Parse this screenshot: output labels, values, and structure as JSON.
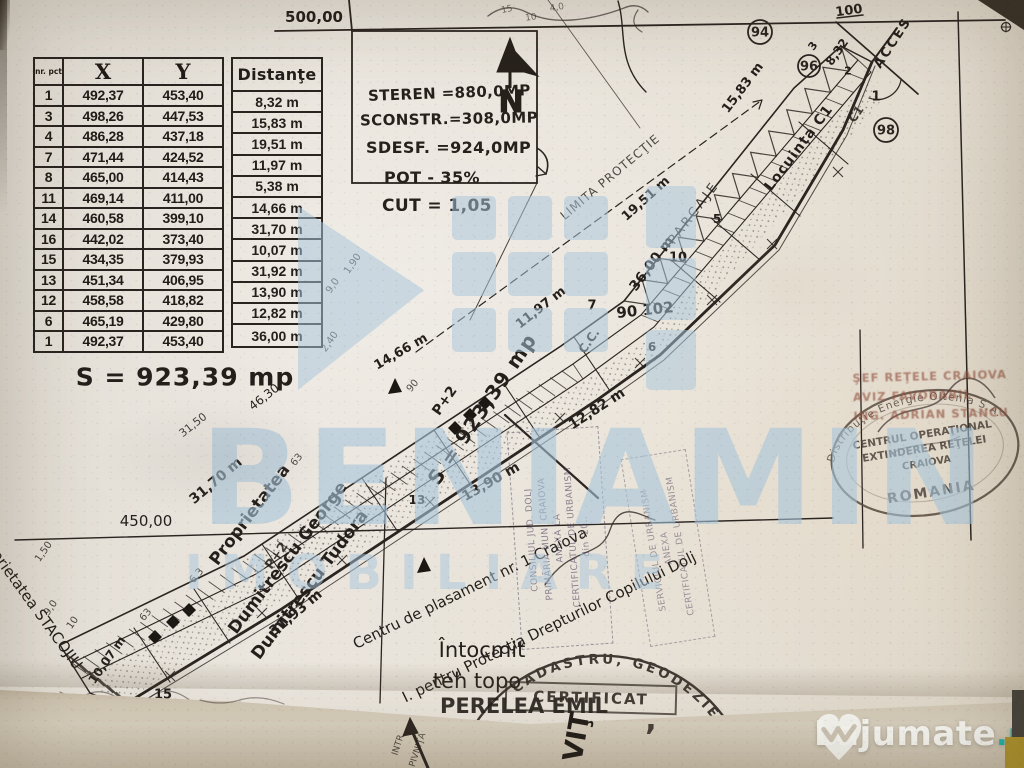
{
  "colors": {
    "paper": "#e8e3dc",
    "ink": "#2b2521",
    "watermark_blue": "#a7c5db",
    "lajumate_teal": "#1db6ae",
    "stamp_red": "#92503e",
    "fold": "#cfc5b2"
  },
  "survey_table": {
    "col_headers": [
      "nr. pct",
      "X",
      "Y"
    ],
    "dist_header": "Distanţe",
    "rows": [
      [
        "1",
        "492,37",
        "453,40"
      ],
      [
        "3",
        "498,26",
        "447,53"
      ],
      [
        "4",
        "486,28",
        "437,18"
      ],
      [
        "7",
        "471,44",
        "424,52"
      ],
      [
        "8",
        "465,00",
        "414,43"
      ],
      [
        "11",
        "469,14",
        "411,00"
      ],
      [
        "14",
        "460,58",
        "399,10"
      ],
      [
        "16",
        "442,02",
        "373,40"
      ],
      [
        "15",
        "434,35",
        "379,93"
      ],
      [
        "13",
        "451,34",
        "406,95"
      ],
      [
        "12",
        "458,58",
        "418,82"
      ],
      [
        "6",
        "465,19",
        "429,80"
      ],
      [
        "1",
        "492,37",
        "453,40"
      ]
    ],
    "distances": [
      "8,32 m",
      "15,83 m",
      "19,51 m",
      "11,97 m",
      "5,38 m",
      "14,66 m",
      "31,70 m",
      "10,07 m",
      "31,92 m",
      "13,90 m",
      "12,82 m",
      "36,00 m"
    ],
    "area": "S = 923,39 mp"
  },
  "parameters": {
    "lines": [
      "STEREN =880,0MP",
      "SCONSTR.=308,0MP",
      "SDESF. =924,0MP",
      "POT - 35%",
      "CUT = 1,05"
    ]
  },
  "north_label": "N",
  "plan_points": [
    {
      "label": "94",
      "x": 760,
      "y": 32,
      "rr": 12
    },
    {
      "label": "96",
      "x": 809,
      "y": 66,
      "rr": 11
    },
    {
      "label": "98",
      "x": 886,
      "y": 130,
      "rr": 12
    }
  ],
  "plan_labels": [
    {
      "t": "500,00",
      "x": 314,
      "y": 17,
      "s": 15,
      "w": 700
    },
    {
      "t": "100",
      "x": 849,
      "y": 11,
      "r": -8,
      "s": 13,
      "w": 700
    },
    {
      "t": "ACCES",
      "x": 893,
      "y": 43,
      "r": -57,
      "s": 13,
      "w": 700,
      "ls": 2
    },
    {
      "t": "8,32",
      "x": 837,
      "y": 52,
      "r": -55,
      "s": 12,
      "w": 700
    },
    {
      "t": "2",
      "x": 848,
      "y": 71,
      "s": 11,
      "w": 700
    },
    {
      "t": "1",
      "x": 876,
      "y": 97,
      "s": 13,
      "w": 700
    },
    {
      "t": "3",
      "x": 813,
      "y": 46,
      "r": -55,
      "s": 11,
      "w": 700
    },
    {
      "t": "C1",
      "x": 856,
      "y": 114,
      "r": -55,
      "s": 12,
      "w": 700,
      "o": 0.85
    },
    {
      "t": "15,83 m",
      "x": 743,
      "y": 88,
      "r": -53,
      "s": 13,
      "w": 700
    },
    {
      "t": "Locuinţa C1",
      "x": 799,
      "y": 148,
      "r": -53,
      "s": 14,
      "w": 700,
      "ls": 1
    },
    {
      "t": "PARCAJE",
      "x": 694,
      "y": 213,
      "r": -53,
      "s": 13,
      "ls": 3,
      "o": 0.85
    },
    {
      "t": "36,00 m",
      "x": 652,
      "y": 264,
      "r": -53,
      "s": 14,
      "w": 700
    },
    {
      "t": "19,51 m",
      "x": 646,
      "y": 199,
      "r": -42,
      "s": 13,
      "w": 700
    },
    {
      "t": "LIMITA PROTECŢIE",
      "x": 610,
      "y": 177,
      "r": -40,
      "s": 12,
      "o": 0.8,
      "ls": 1
    },
    {
      "t": "5",
      "x": 717,
      "y": 219,
      "s": 12,
      "w": 700
    },
    {
      "t": "10",
      "x": 678,
      "y": 258,
      "s": 13,
      "w": 700
    },
    {
      "t": "7",
      "x": 592,
      "y": 306,
      "s": 13,
      "w": 700
    },
    {
      "t": "90 102",
      "x": 645,
      "y": 310,
      "r": -6,
      "s": 15,
      "w": 700
    },
    {
      "t": "C.C.",
      "x": 589,
      "y": 341,
      "r": -55,
      "s": 12,
      "w": 700
    },
    {
      "t": "11,97 m",
      "x": 541,
      "y": 308,
      "r": -38,
      "s": 13,
      "w": 700
    },
    {
      "t": "14,66 m",
      "x": 401,
      "y": 352,
      "r": -30,
      "s": 13,
      "w": 700
    },
    {
      "t": "6",
      "x": 652,
      "y": 347,
      "s": 12,
      "w": 700
    },
    {
      "t": "12,82 m",
      "x": 597,
      "y": 409,
      "r": -33,
      "s": 14,
      "w": 700
    },
    {
      "t": "S = 923,39 mp",
      "x": 482,
      "y": 409,
      "r": -56,
      "s": 20,
      "w": 700,
      "ls": 1
    },
    {
      "t": "P+2",
      "x": 445,
      "y": 401,
      "r": -55,
      "s": 14,
      "w": 700
    },
    {
      "t": "P+2",
      "x": 277,
      "y": 556,
      "r": -55,
      "s": 13,
      "w": 600,
      "o": 0.85
    },
    {
      "t": "90",
      "x": 413,
      "y": 386,
      "r": -50,
      "s": 10,
      "o": 0.8
    },
    {
      "t": "2,40",
      "x": 330,
      "y": 342,
      "r": -55,
      "s": 10,
      "o": 0.8
    },
    {
      "t": "9,0",
      "x": 333,
      "y": 286,
      "r": -55,
      "s": 10,
      "o": 0.8
    },
    {
      "t": "1,90",
      "x": 353,
      "y": 264,
      "r": -55,
      "s": 10,
      "o": 0.8
    },
    {
      "t": "46,30",
      "x": 264,
      "y": 397,
      "r": -38,
      "s": 12
    },
    {
      "t": "31,50",
      "x": 193,
      "y": 425,
      "r": -38,
      "s": 11,
      "o": 0.85
    },
    {
      "t": "31,70 m",
      "x": 216,
      "y": 481,
      "r": -40,
      "s": 14,
      "w": 700
    },
    {
      "t": "450,00",
      "x": 146,
      "y": 521,
      "s": 15
    },
    {
      "t": "13,90 m",
      "x": 491,
      "y": 482,
      "r": -30,
      "s": 14,
      "w": 700
    },
    {
      "t": "13",
      "x": 417,
      "y": 500,
      "s": 12,
      "w": 700
    },
    {
      "t": "63",
      "x": 297,
      "y": 460,
      "r": -50,
      "s": 10,
      "o": 0.8
    },
    {
      "t": "6,3",
      "x": 197,
      "y": 576,
      "r": -50,
      "s": 10,
      "o": 0.8
    },
    {
      "t": "63",
      "x": 146,
      "y": 615,
      "r": -50,
      "s": 10,
      "o": 0.8
    },
    {
      "t": "31,93 m",
      "x": 296,
      "y": 613,
      "r": -40,
      "s": 14,
      "w": 700
    },
    {
      "t": "10,07 m",
      "x": 107,
      "y": 660,
      "r": -55,
      "s": 12,
      "w": 700
    },
    {
      "t": "9,0",
      "x": 51,
      "y": 608,
      "r": -55,
      "s": 10,
      "o": 0.8
    },
    {
      "t": "10",
      "x": 73,
      "y": 623,
      "r": -55,
      "s": 10,
      "o": 0.8
    },
    {
      "t": "1,50",
      "x": 44,
      "y": 552,
      "r": -55,
      "s": 10,
      "o": 0.8
    },
    {
      "t": "15",
      "x": 163,
      "y": 695,
      "s": 13,
      "w": 700
    },
    {
      "t": "S = 923,39 mp",
      "x": 185,
      "y": 377,
      "s": 25,
      "w": 700,
      "ls": 1
    },
    {
      "t": "Proprietatea",
      "x": 250,
      "y": 515,
      "r": -53,
      "s": 17,
      "w": 600
    },
    {
      "t": "Dumitrescu George",
      "x": 288,
      "y": 558,
      "r": -53,
      "s": 17,
      "w": 600
    },
    {
      "t": "Dumitrescu Tudora",
      "x": 310,
      "y": 585,
      "r": -53,
      "s": 17,
      "w": 600
    },
    {
      "t": "Proprietatea STACOJIU",
      "x": 30,
      "y": 600,
      "r": 54,
      "s": 15,
      "w": 500
    },
    {
      "t": "Centru de plasament nr. 1 Craiova",
      "x": 470,
      "y": 588,
      "r": -26,
      "s": 15,
      "w": 500
    },
    {
      "t": "I. pentru Protecţia Drepturilor Copilului Dolj",
      "x": 549,
      "y": 627,
      "r": -26,
      "s": 15,
      "w": 500
    },
    {
      "t": "Întocmit",
      "x": 482,
      "y": 650,
      "s": 21,
      "w": 500
    },
    {
      "t": "teh topo",
      "x": 477,
      "y": 681,
      "s": 21,
      "w": 500
    },
    {
      "t": "PERELEA EMIL",
      "x": 524,
      "y": 706,
      "s": 21,
      "w": 700,
      "o": 0.9
    },
    {
      "t": "15",
      "x": 507,
      "y": 10,
      "r": -12,
      "s": 9,
      "o": 0.6
    },
    {
      "t": "10",
      "x": 531,
      "y": 18,
      "r": -8,
      "s": 9,
      "o": 0.6
    },
    {
      "t": "4,0",
      "x": 557,
      "y": 8,
      "r": -10,
      "s": 9,
      "o": 0.6
    }
  ],
  "under_labels": [
    {
      "t": "VIŢ",
      "x": 577,
      "y": 737,
      "r": -80,
      "s": 27,
      "w": 700
    },
    {
      "t": ",",
      "x": 651,
      "y": 720,
      "s": 30,
      "w": 700,
      "o": 0.8
    },
    {
      "t": "INTR.",
      "x": 399,
      "y": 744,
      "r": -72,
      "s": 9,
      "o": 0.75
    },
    {
      "t": "PIVNIŢA",
      "x": 418,
      "y": 750,
      "r": -72,
      "s": 9,
      "o": 0.75
    }
  ],
  "stamps": {
    "energy_oval": {
      "ring": "Distribuţie Energie Oltenia S.A.",
      "lines": [
        "CENTRUL OPERAŢIONAL",
        "EXTINDEREA REŢELEI",
        "CRAIOVA",
        "ROMANIA"
      ]
    },
    "aviz": {
      "lines": [
        "ŞEF REŢELE CRAIOVA",
        "AVIZ FAVORABIL",
        "ING. ADRIAN STANCU"
      ]
    },
    "cadastru": {
      "arc": "CADASTRU, GEODEZIE",
      "box": "CERTIFICAT"
    },
    "urbanism1": {
      "lines": [
        "CONSILIUL JUD. DOLJ",
        "PRIMĂRIA MUN. CRAIOVA",
        "ANEXA LA",
        "CERTIFICATUL DE URBANISM",
        "din '20.."
      ]
    },
    "urbanism2": {
      "lines": [
        "SERVICIUL DE URBANISM",
        "ANEXA",
        "CERTIFICATUL DE URBANISM"
      ]
    }
  },
  "watermark": {
    "brand": "BENIAMIN",
    "brand_sub": "IMOBILIARE"
  },
  "footer_logo": {
    "name": "Lajumate",
    "tld": ".ro"
  }
}
